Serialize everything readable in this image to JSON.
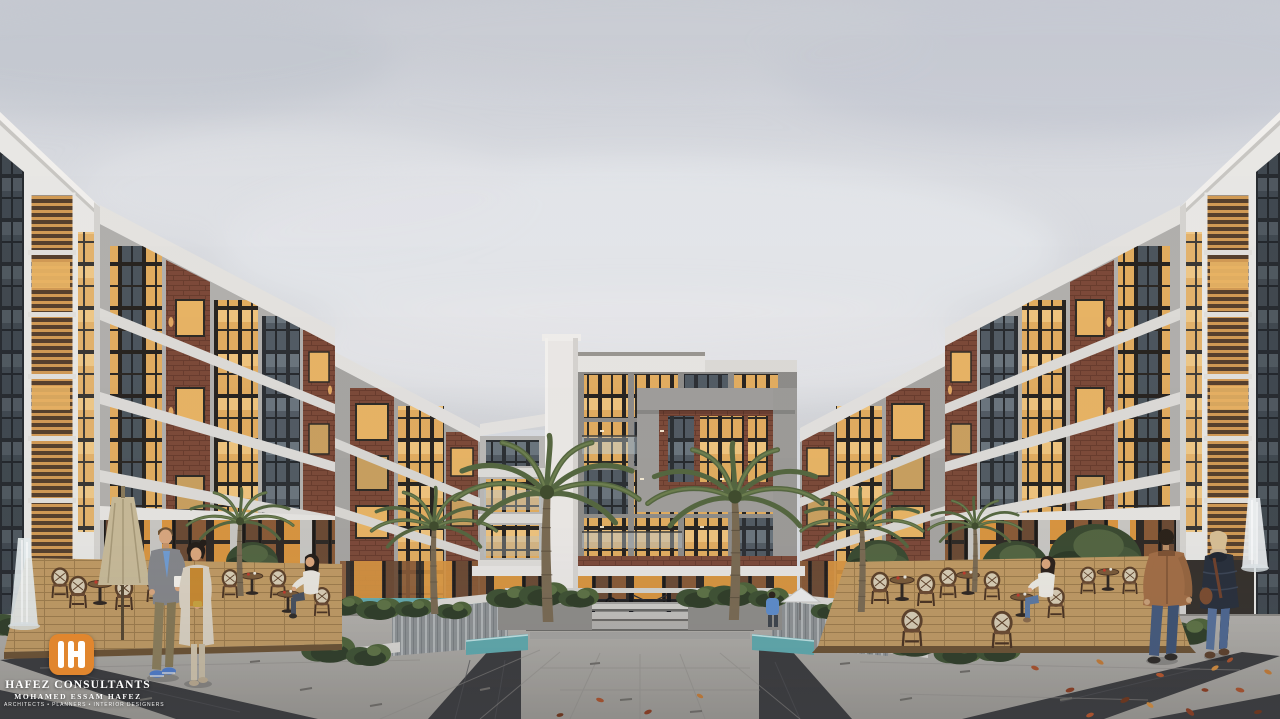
{
  "watermark": {
    "monogram": "H",
    "title": "HAFEZ CONSULTANTS",
    "subtitle": "MOHAMED ESSAM HAFEZ",
    "tagline": "ARCHITECTS • PLANNERS • INTERIOR DESIGNERS",
    "brand_color": "#E1862E",
    "text_color": "#FFFFFF"
  },
  "scene": {
    "type": "architectural-exterior-rendering",
    "setting": "residential apartment compound courtyard at dusk, overcast sky",
    "elements": [
      "symmetric modern apartment buildings with white frames, gray concrete and brick facades",
      "warm lit floor-to-ceiling windows and glass balconies",
      "central five-storey building flanked by two tall palm trees",
      "sunken water court with waterfall walls and teal pools",
      "steel truss railing bridge over the water court",
      "planters with shrubs and deciduous trees",
      "outdoor cafe terraces on wood decks with rattan bistro chairs and round tables",
      "closed beige patio umbrella on left terrace",
      "couple walking toward viewer on left (man gray blazer blue shirt, woman cream coat)",
      "couple walking away on right (man tan leather jacket, woman navy puffer with bag)",
      "seated women at cafe tables",
      "granite paving with dark diagonal bands",
      "scattered autumn leaves on the right plaza",
      "thin white fountain jets at left and right edges"
    ],
    "palette": {
      "sky": "#D9DCE1",
      "facade_white": "#E9E8E5",
      "facade_gray": "#A9A7A4",
      "brick": "#7C4938",
      "window_glow": "#E3AD5F",
      "greenery": "#46532F",
      "water": "#5FA9AD",
      "pavement": "#A8A5A0",
      "pavement_dark_band": "#3A3A3C",
      "deck_wood": "#C09A63"
    }
  }
}
